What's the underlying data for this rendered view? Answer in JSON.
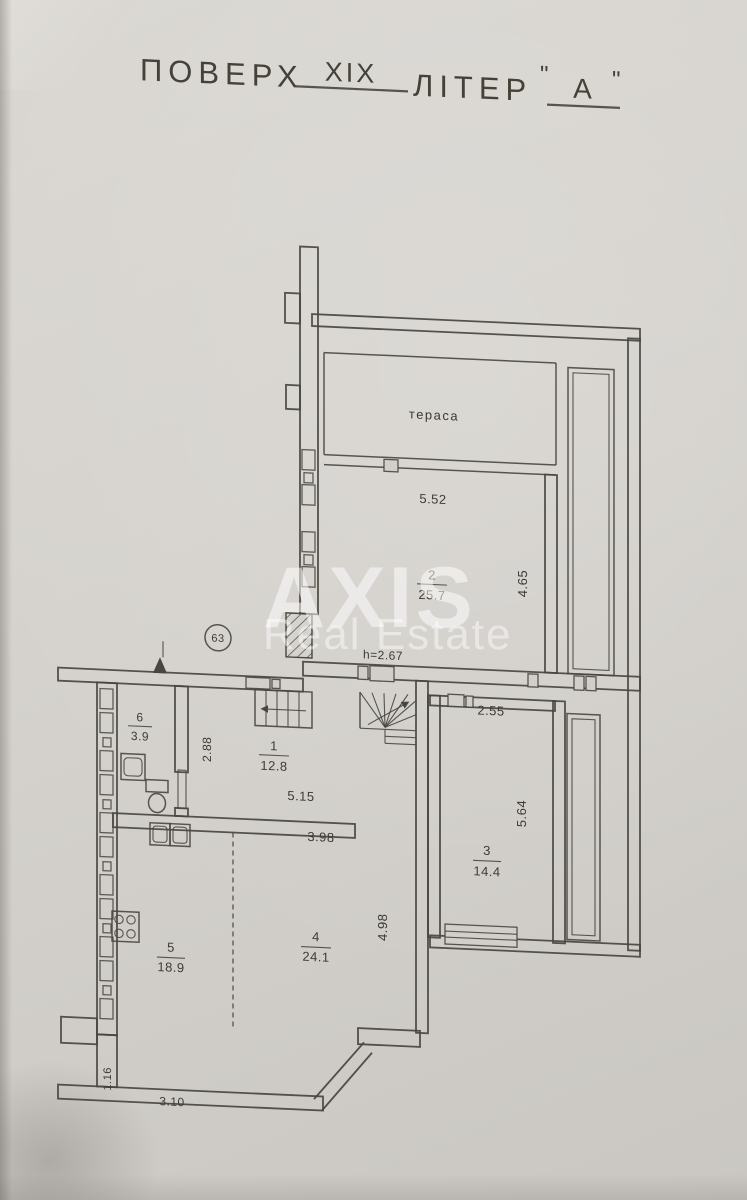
{
  "header": {
    "floor_label": "ПОВЕРХ",
    "floor_value": "XIX",
    "letter_label": "ЛІТЕР",
    "quote_open": "\"",
    "letter_value": "А",
    "quote_close": "\""
  },
  "watermark": {
    "line1": "AXIS",
    "line2": "Real Estate"
  },
  "plan": {
    "unit_number": "63",
    "terrace_label": "тераса",
    "height_note": "h=2.67",
    "rooms": [
      {
        "number": "1",
        "area": "12.8"
      },
      {
        "number": "2",
        "area": "25.7"
      },
      {
        "number": "3",
        "area": "14.4"
      },
      {
        "number": "4",
        "area": "24.1"
      },
      {
        "number": "5",
        "area": "18.9"
      },
      {
        "number": "6",
        "area": "3.9"
      }
    ],
    "dimensions": {
      "room2_width": "5.52",
      "room2_depth": "4.65",
      "room3_width": "2.55",
      "room3_depth": "5.64",
      "hall_depth": "2.88",
      "hall_width": "5.15",
      "room4_width": "3.98",
      "room4_depth": "4.98",
      "passage_width": "1.16",
      "bottom_width": "3.10"
    }
  },
  "colors": {
    "paper": "#d5d2cd",
    "line": "#49453f",
    "text": "#3d3a35",
    "watermark": "#ffffff"
  }
}
